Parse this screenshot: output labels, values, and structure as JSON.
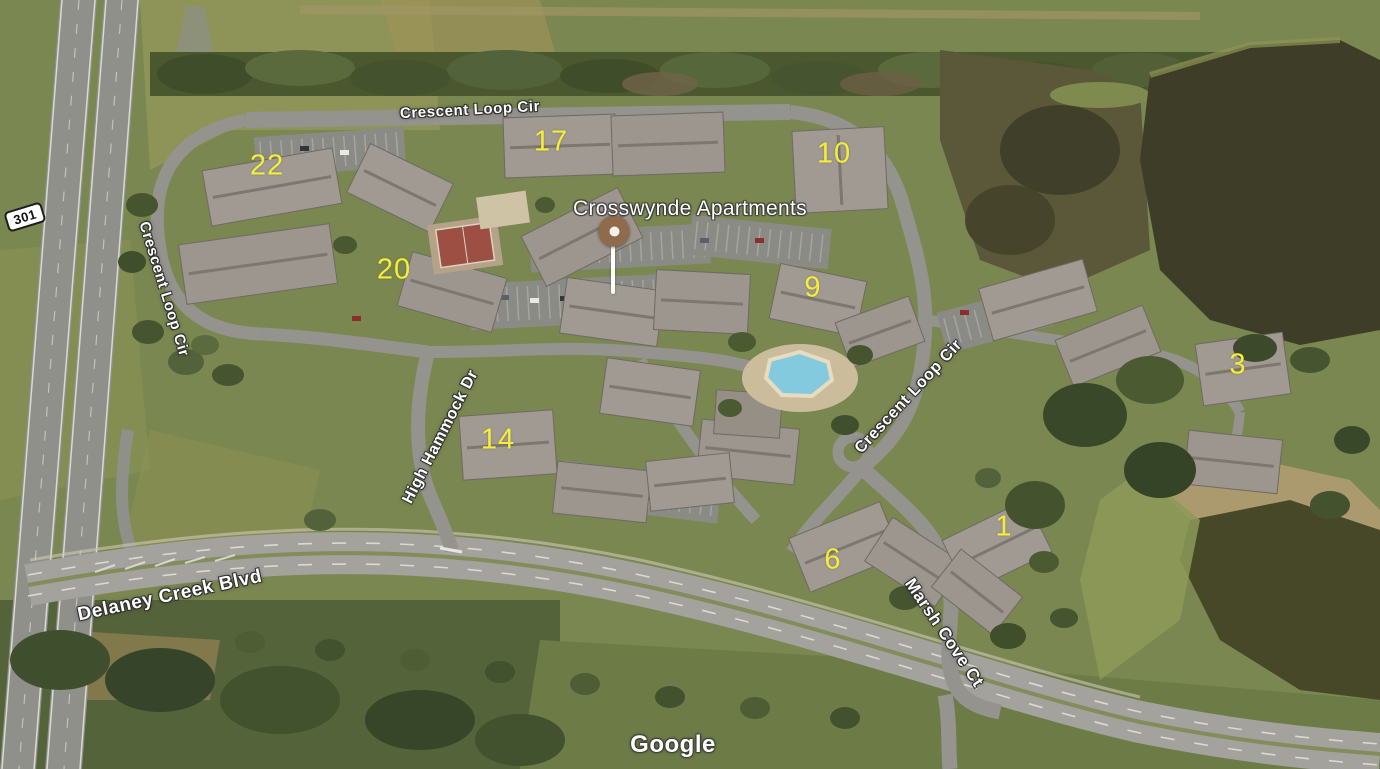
{
  "map": {
    "type": "satellite",
    "place": {
      "name": "Crosswynde Apartments"
    },
    "attribution": {
      "logo_text": "Google"
    },
    "highway_shield": {
      "number": "301"
    },
    "streets": [
      {
        "id": "crescent-loop-cir-north",
        "text": "Crescent Loop Cir"
      },
      {
        "id": "crescent-loop-cir-west",
        "text": "Crescent Loop Cir"
      },
      {
        "id": "crescent-loop-cir-east",
        "text": "Crescent Loop Cir"
      },
      {
        "id": "high-hammock-dr",
        "text": "High Hammock Dr"
      },
      {
        "id": "delaney-creek-blvd",
        "text": "Delaney Creek Blvd"
      },
      {
        "id": "marsh-cove-ct",
        "text": "Marsh Cove Ct"
      }
    ],
    "building_numbers": [
      "22",
      "17",
      "10",
      "20",
      "9",
      "3",
      "14",
      "1",
      "6"
    ],
    "colors": {
      "building_number_yellow": "#f4ee3b",
      "street_label_fill": "#ffffff",
      "street_label_outline": "#2d2d2d",
      "marker_brown": "#8f6b4c",
      "water_dark": "#3e3d27",
      "grass": "#7a8750",
      "road_gray": "#94938d",
      "pool_blue": "#84cade"
    }
  }
}
